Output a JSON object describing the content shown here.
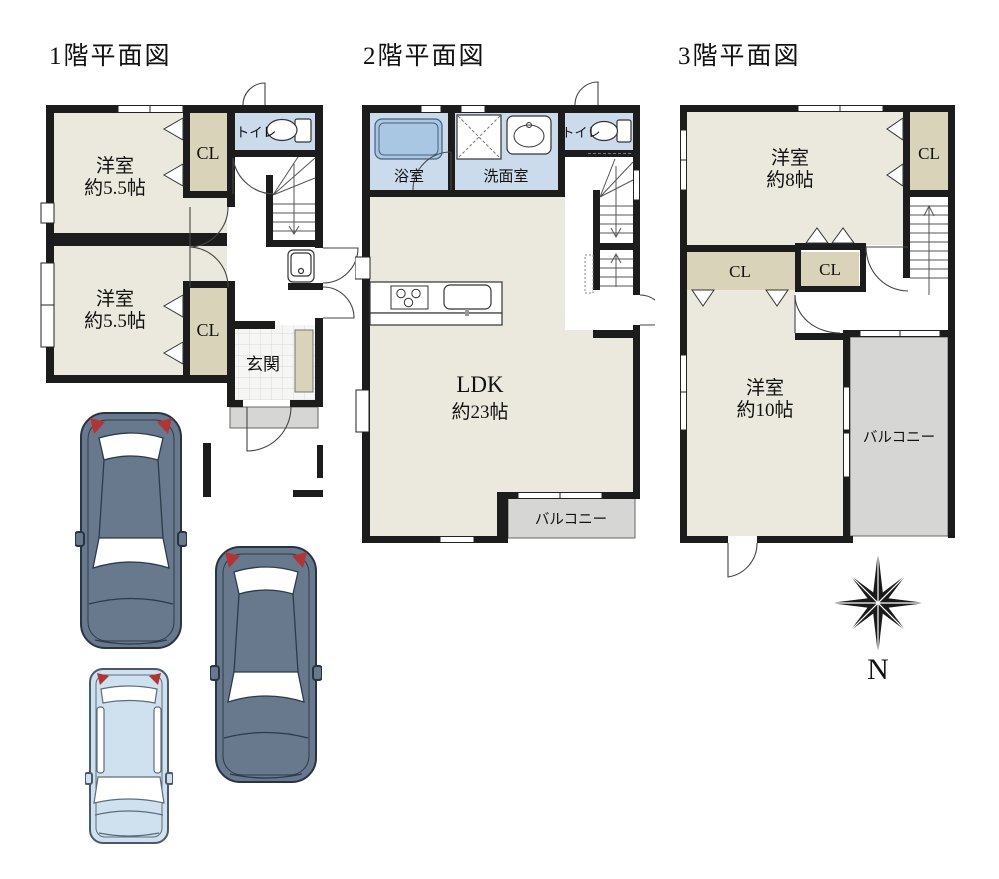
{
  "colors": {
    "wall": "#1c1c1c",
    "room_floor": "#ebe9dd",
    "closet": "#d9d3ba",
    "wet_room": "#cbdbec",
    "bathtub": "#a9c6e2",
    "balcony": "#d6d6d4",
    "car_dark": "#68798d",
    "car_light": "#cfe0ee",
    "taillight_red": "#b23434"
  },
  "floor1": {
    "title": "1階平面図",
    "toilet": "トイレ",
    "closet_a": "CL",
    "closet_b": "CL",
    "room_a": {
      "line1": "洋室",
      "line2": "約5.5帖"
    },
    "room_b": {
      "line1": "洋室",
      "line2": "約5.5帖"
    },
    "entrance": "玄関"
  },
  "floor2": {
    "title": "2階平面図",
    "bathroom": "浴室",
    "washroom": "洗面室",
    "toilet": "トイレ",
    "ldk": {
      "line1": "LDK",
      "line2": "約23帖"
    },
    "balcony": "バルコニー"
  },
  "floor3": {
    "title": "3階平面図",
    "room_a": {
      "line1": "洋室",
      "line2": "約8帖"
    },
    "closet_a": "CL",
    "closet_b": "CL",
    "closet_c": "CL",
    "room_b": {
      "line1": "洋室",
      "line2": "約10帖"
    },
    "balcony": "バルコニー"
  },
  "compass": {
    "label": "N"
  },
  "icons": {
    "toilet": "toilet-icon",
    "bathtub": "bathtub-icon",
    "sink": "sink-icon",
    "stove": "stove-icon",
    "washer_pan": "washer-pan-icon",
    "compass": "compass-rose-icon",
    "car": "car-top-view-icon"
  }
}
